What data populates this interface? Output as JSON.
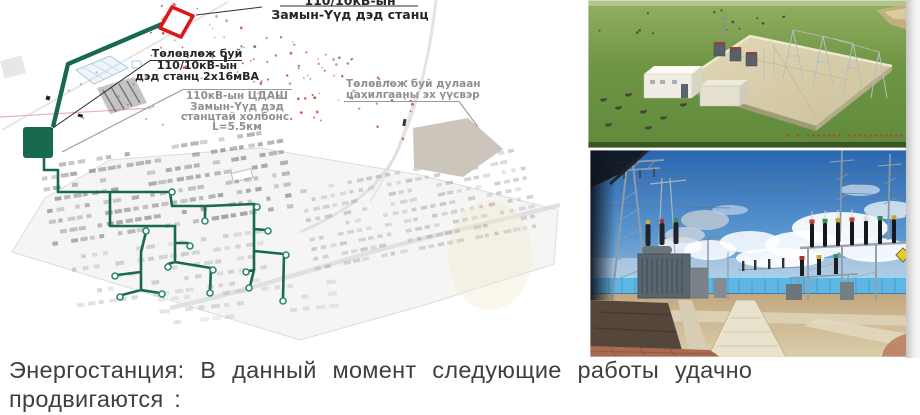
{
  "slide": {
    "caption_line1": "Энергостанция: В данный момент следующие работы удачно",
    "caption_line2": "продвигаются :",
    "caption_color": "#3f3f3f"
  },
  "map": {
    "labels": {
      "substation_top_line1": "110/10кВ-ын",
      "substation_top_line2": "Замын-Үүд дэд станц",
      "planned_substation_line1": "Төлөвлөж буй",
      "planned_substation_line2": "110/10кВ-ын",
      "planned_substation_line3": "дэд станц 2х16мВА",
      "power_line_line1": "110кВ-ын ЦДАШ",
      "power_line_line2": "Замын-Үүд дэд",
      "power_line_line3": "станцтай холбонс.",
      "power_line_line4": "L=5.5км",
      "heat_source_line1": "Төлөвлөж буй дулаан",
      "heat_source_line2": "цахилгааны эх үүсвэр"
    },
    "colors": {
      "network_green": "#17694f",
      "node_stroke": "#2e8b63",
      "marker_red": "#e01616",
      "planned_area_gray": "#cbc5bb",
      "label_gray": "#909090",
      "label_black": "#262626"
    }
  },
  "photos": {
    "top": {
      "description": "3D render of planned substation on grassland"
    },
    "bottom": {
      "description": "Photo of completed substation switchyard"
    }
  }
}
